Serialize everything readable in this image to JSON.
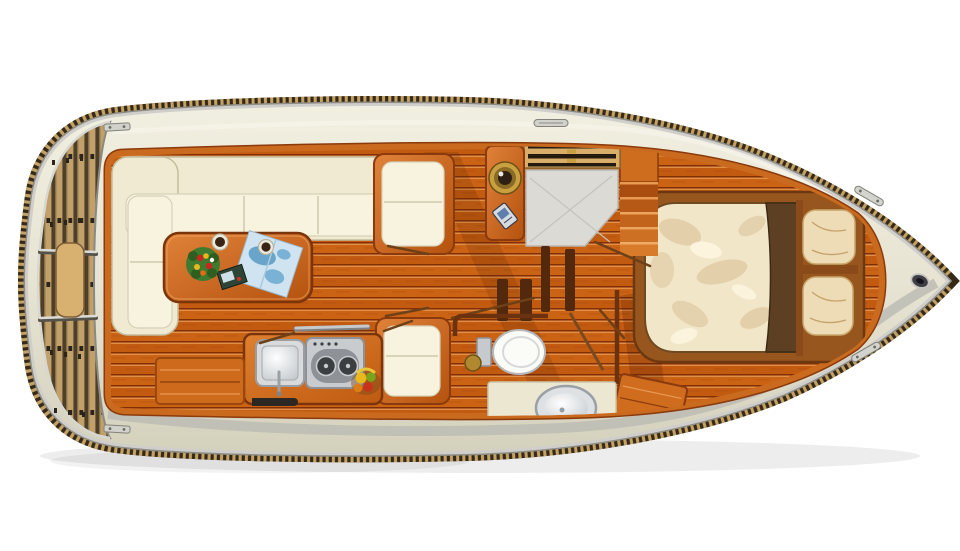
{
  "scene": {
    "kind": "boat-floor-plan",
    "view": "top-down",
    "description_label": ""
  },
  "palette": {
    "background": "#ffffff",
    "rope_rail": "#6e5838",
    "rope_dark": "#362a16",
    "rope_light": "#c3a268",
    "rim_dark": "#8e8d85",
    "rim_silver": "#cfceca",
    "deck": "#e8e5d4",
    "deck_shadow": "#bdbcb4",
    "deck_highlight": "#f6f4ea",
    "floor_trim": "#c96a1e",
    "floor_trim_dark": "#8a3a0c",
    "wood_mid": "#cf6d1e",
    "wood_dark": "#7c350a",
    "teak": "#c2a06a",
    "sofa": "#f0ead3",
    "sofa_edge": "#c3bd9f",
    "cushion": "#f7f3df",
    "bed_frame": "#98561f",
    "duvet": "#f2e6c9",
    "duvet_shade": "#d9bf96",
    "runner": "#5d4023",
    "pillow": "#eedcb6",
    "steel": "#c6cacc",
    "steel_dark": "#8e9296",
    "porcelain": "#fbfbf8",
    "vanity": "#ece7d0",
    "chart_blue": "#cfe4f0",
    "chart_blue_deep": "#4f93c0",
    "leaf_green": "#3f7a2e",
    "flower_red": "#cc2420",
    "flower_yellow": "#e8b81c",
    "gold": "#c9a040",
    "partition": "#52290d",
    "landing_gray": "#dbdad4"
  },
  "rooms": [
    {
      "name": "swim-platform",
      "items": [
        "teak-planks",
        "boarding-step",
        "metal-dividers"
      ]
    },
    {
      "name": "saloon",
      "items": [
        "l-shaped-sofa",
        "dining-table",
        "flower-bouquet",
        "coffee-cup",
        "coffee-cup",
        "nautical-chart",
        "magazine",
        "side-chair"
      ]
    },
    {
      "name": "galley",
      "items": [
        "counter",
        "sink",
        "two-burner-stove",
        "fruit-bowl",
        "grab-rail",
        "chair"
      ]
    },
    {
      "name": "companionway",
      "items": [
        "slatted-hatch",
        "porthole-cabinet",
        "landing",
        "steps"
      ]
    },
    {
      "name": "head",
      "items": [
        "toilet",
        "washbasin",
        "vanity-counter",
        "latch"
      ]
    },
    {
      "name": "bow-cabin",
      "items": [
        "double-bed",
        "bed-runner",
        "pillow",
        "pillow",
        "step-box"
      ]
    },
    {
      "name": "deck",
      "items": [
        "cleat",
        "cleat",
        "hinge",
        "hinge",
        "latch",
        "bow-fitting"
      ]
    }
  ]
}
